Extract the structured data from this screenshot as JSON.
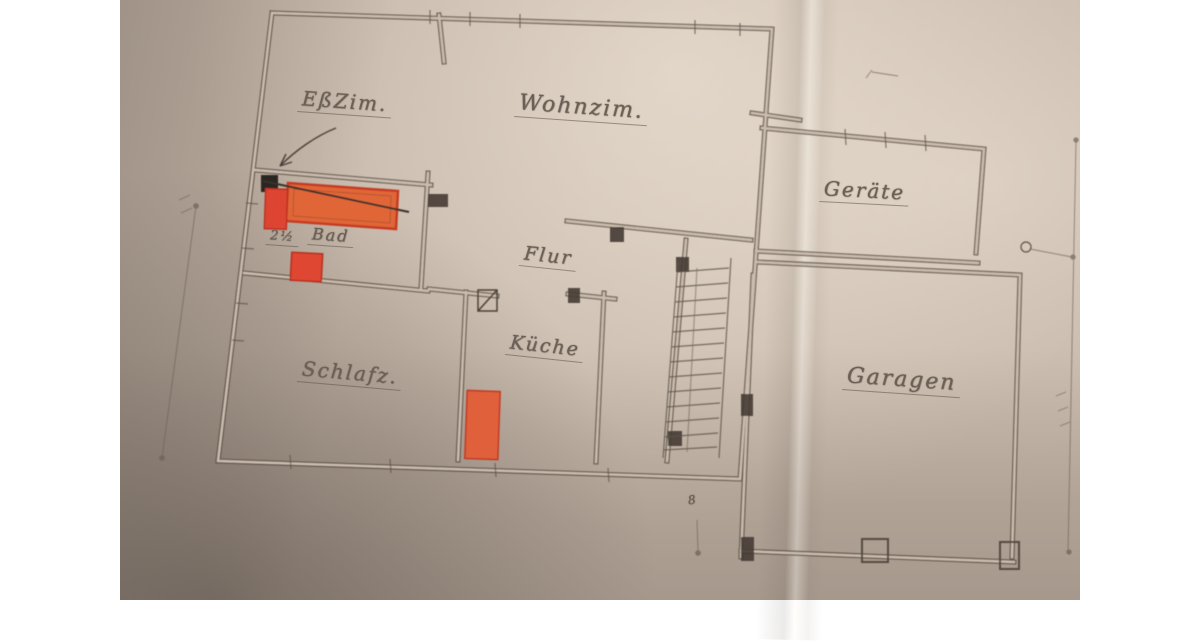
{
  "photo": {
    "description_label": "hand-drawn floor plan photograph",
    "paper_color": "#c2b3a5",
    "pencil_color": "#5d5349",
    "highlight_orange": "#e0603a",
    "highlight_red_border": "#c63b22"
  },
  "rooms": [
    {
      "id": "eszim",
      "label": "EßZim."
    },
    {
      "id": "wohnzim",
      "label": "Wohnzim."
    },
    {
      "id": "geraete",
      "label": "Geräte"
    },
    {
      "id": "bad",
      "label": "Bad",
      "note": "2½"
    },
    {
      "id": "flur",
      "label": "Flur"
    },
    {
      "id": "schlafz",
      "label": "Schlafz."
    },
    {
      "id": "kueche",
      "label": "Küche"
    },
    {
      "id": "garagen",
      "label": "Garagen"
    }
  ],
  "annotations": {
    "bottom_dimension": "8"
  }
}
